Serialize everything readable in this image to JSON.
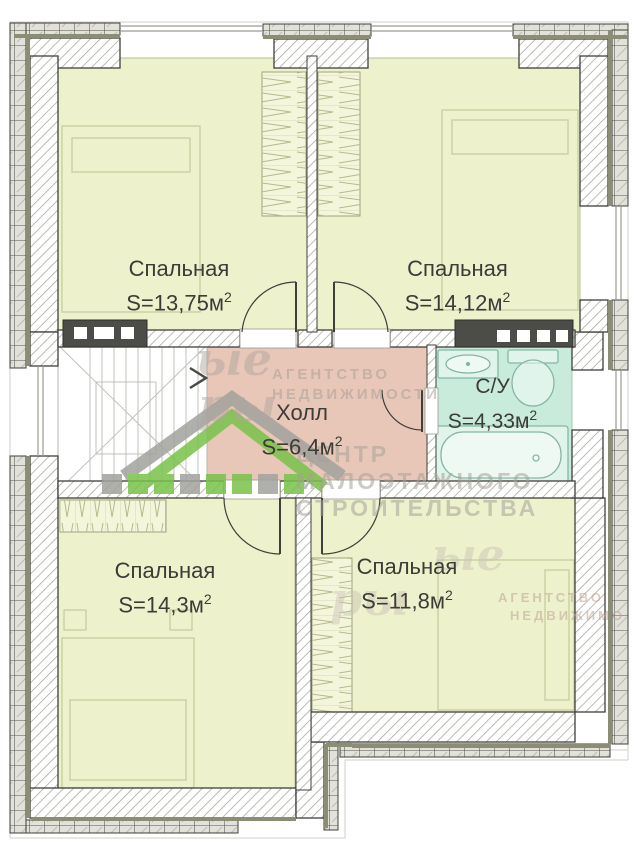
{
  "rooms": [
    {
      "id": "bedroom-top-left",
      "name": "Спальная",
      "area": "S=13,75м",
      "sup": "2"
    },
    {
      "id": "bedroom-top-right",
      "name": "Спальная",
      "area": "S=14,12м",
      "sup": "2"
    },
    {
      "id": "hall",
      "name": "Холл",
      "area": "S=6,4м",
      "sup": "2"
    },
    {
      "id": "bathroom",
      "name": "С/У",
      "area": "S=4,33м",
      "sup": "2"
    },
    {
      "id": "bedroom-bottom-left",
      "name": "Спальная",
      "area": "S=14,3м",
      "sup": "2"
    },
    {
      "id": "bedroom-bottom-right",
      "name": "Спальная",
      "area": "S=11,8м",
      "sup": "2"
    }
  ],
  "watermarks": {
    "script_top_line1": "ые",
    "script_top_line2": "ры",
    "agency_line1": "АГЕНТСТВО",
    "agency_line2": "НЕДВИЖИМОСТИ",
    "center_line1": "ЦЕНТР",
    "center_line2": "МАЛОЭТАЖНОГО",
    "center_line3": "СТРОИТЕЛЬСТВА",
    "script_bottom_line1": "ые",
    "script_bottom_line2": "ры",
    "agency2_line1": "АГЕНТСТВО",
    "agency2_line2": "НЕДВИЖИМО"
  },
  "colors": {
    "bedroom_fill": "#edf2cd",
    "hall_fill": "#e9c7b8",
    "bathroom_fill": "#c9ebdc",
    "wall_line": "#3f3f3b",
    "logo_green": "#79c24a",
    "logo_gray": "#a2a29e"
  }
}
